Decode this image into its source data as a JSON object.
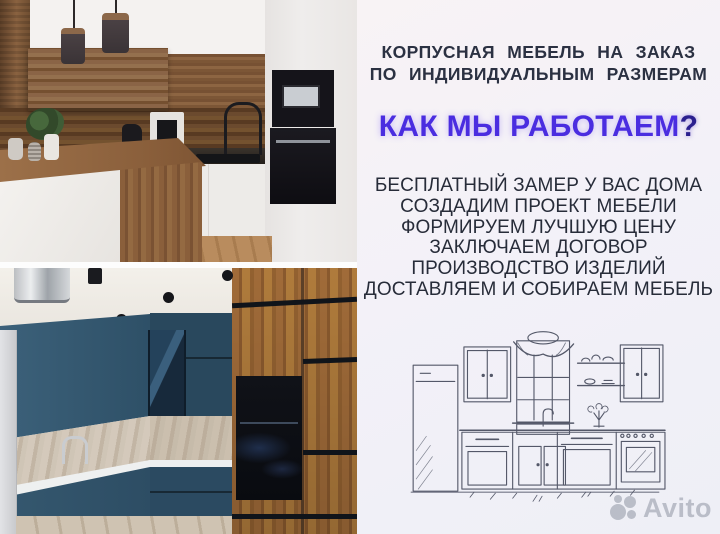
{
  "right_panel": {
    "headline": {
      "line1": "КОРПУСНАЯ МЕБЕЛЬ НА ЗАКАЗ",
      "line2": "ПО ИНДИВИДУАЛЬНЫМ РАЗМЕРАМ"
    },
    "subtitle": {
      "text": "КАК МЫ РАБОТАЕМ",
      "question_mark": "?"
    },
    "steps": [
      "БЕСПЛАТНЫЙ ЗАМЕР У ВАС ДОМА",
      "СОЗДАДИМ ПРОЕКТ МЕБЕЛИ",
      "ФОРМИРУЕМ ЛУЧШУЮ ЦЕНУ",
      "ЗАКЛЮЧАЕМ ДОГОВОР",
      "ПРОИЗВОДСТВО ИЗДЕЛИЙ",
      "ДОСТАВЛЯЕМ И СОБИРАЕМ МЕБЕЛЬ"
    ],
    "sketch": {
      "name": "kitchen-line-drawing"
    }
  },
  "photos": {
    "top": {
      "name": "white-wood-kitchen-photo"
    },
    "bottom": {
      "name": "teal-wood-kitchen-photo"
    }
  },
  "watermark": {
    "logo": "avito-dots-logo",
    "text": "Avito"
  },
  "colors": {
    "accent_violet": "#4a2de0",
    "headline_text": "#2b3142",
    "steps_text": "#272c39",
    "panel_background": "#f3f1f8",
    "teal_cabinet": "#2e4d63",
    "wood": "#9a6b46",
    "watermark_grey": "#8f96a3"
  }
}
